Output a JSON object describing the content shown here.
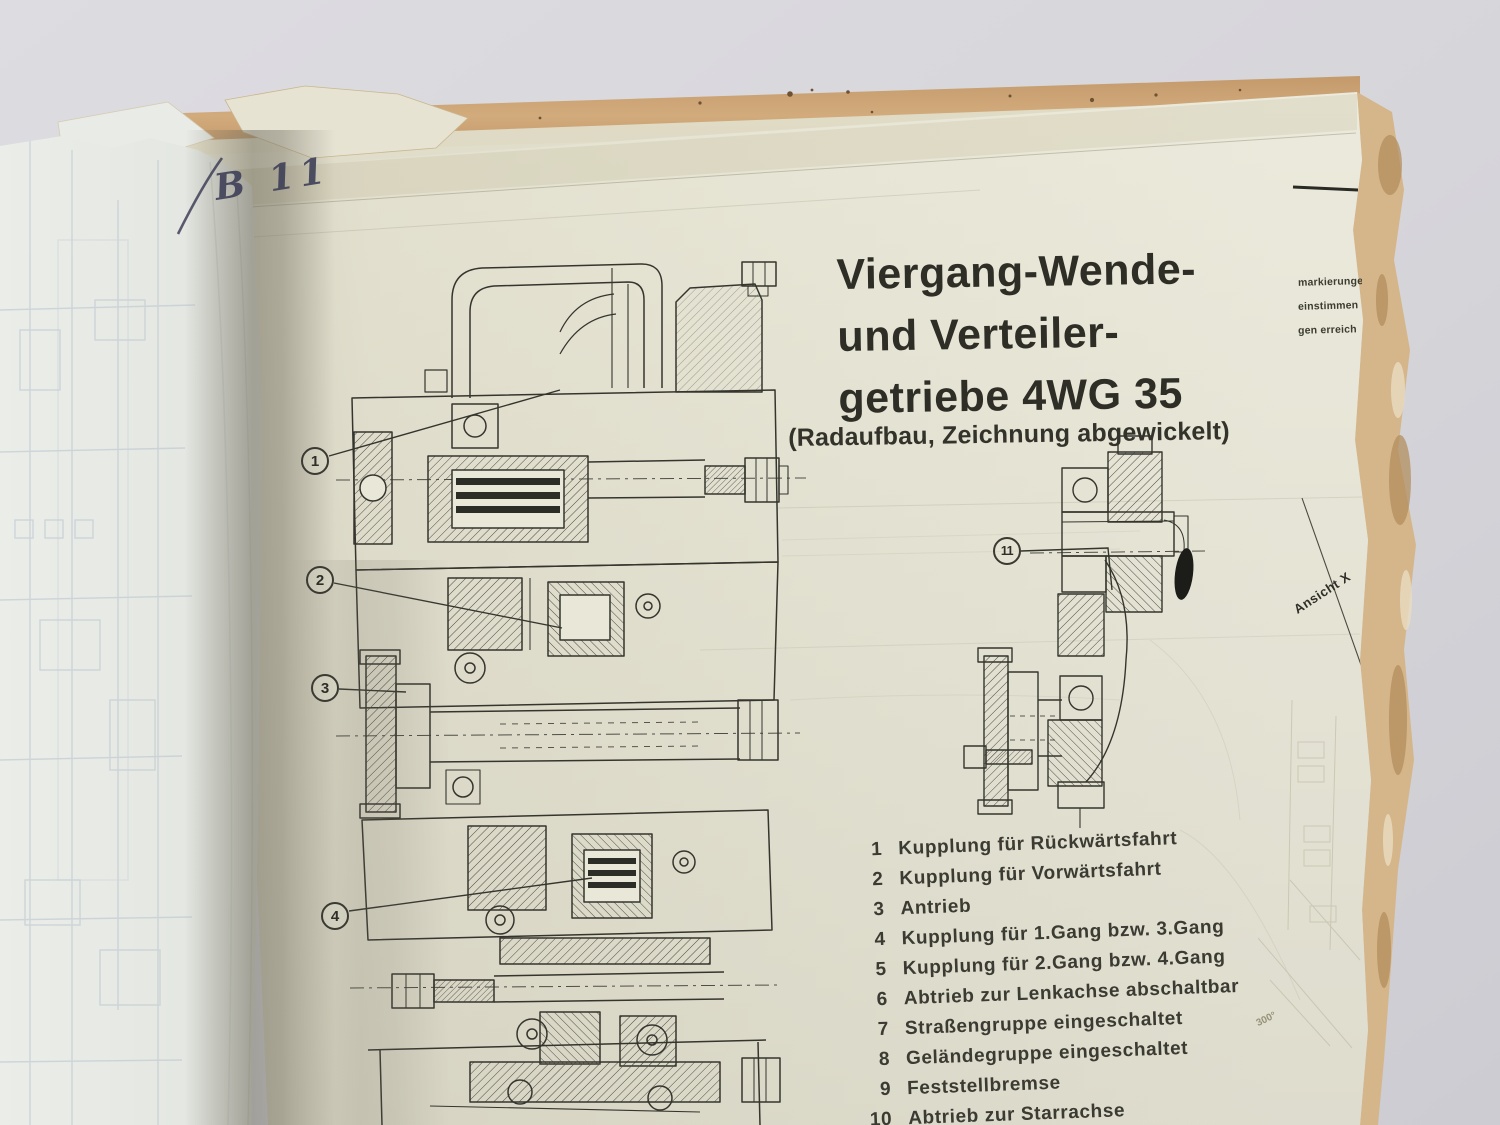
{
  "handwritten_label": {
    "text": "B 11"
  },
  "title": {
    "line1": "Viergang-Wende-",
    "line2": "und Verteiler-",
    "line3": "getriebe 4WG 35",
    "subtitle": "(Radaufbau, Zeichnung abgewickelt)"
  },
  "legend": {
    "items": [
      {
        "num": "1",
        "label": "Kupplung für Rückwärtsfahrt"
      },
      {
        "num": "2",
        "label": "Kupplung für Vorwärtsfahrt"
      },
      {
        "num": "3",
        "label": "Antrieb"
      },
      {
        "num": "4",
        "label": "Kupplung für 1.Gang bzw. 3.Gang"
      },
      {
        "num": "5",
        "label": "Kupplung für 2.Gang bzw. 4.Gang"
      },
      {
        "num": "6",
        "label": "Abtrieb zur Lenkachse abschaltbar"
      },
      {
        "num": "7",
        "label": "Straßengruppe eingeschaltet"
      },
      {
        "num": "8",
        "label": "Geländegruppe eingeschaltet"
      },
      {
        "num": "9",
        "label": "Feststellbremse"
      },
      {
        "num": "10",
        "label": "Abtrieb zur Starrachse"
      }
    ]
  },
  "callouts": {
    "c1": "1",
    "c2": "2",
    "c3": "3",
    "c4": "4",
    "c11": "11"
  },
  "annotations": {
    "view_label": "Ansicht X",
    "angle_fragment": "300°"
  },
  "edge_fragments": {
    "line1": "markierunge",
    "line2": "einstimmen",
    "line3": "gen erreich"
  },
  "colors": {
    "background_gray": "#d6d5da",
    "paper_cream": "#e9e7d7",
    "paper_white": "#e9ebe7",
    "board_tan": "#cfa77a",
    "torn_edge_tan": "#d5b68a",
    "ink": "#35352e",
    "handwriting_blue": "#3f4058"
  }
}
